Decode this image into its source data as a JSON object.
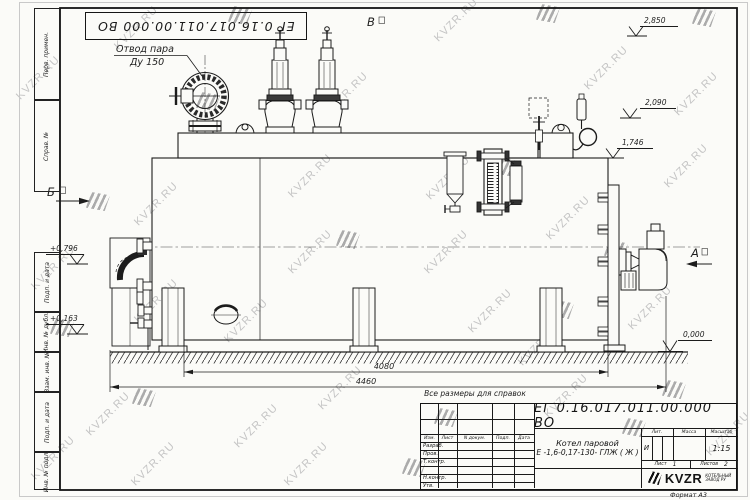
{
  "page": {
    "format_label": "Формат А3"
  },
  "watermark": {
    "text": "KVZR.RU",
    "text_color": "#c4c4c4",
    "logo_color": "#ababab"
  },
  "watermarks": [
    {
      "t": "text",
      "x": 108,
      "y": 22
    },
    {
      "t": "logo",
      "x": 228,
      "y": 6
    },
    {
      "t": "text",
      "x": 428,
      "y": 14
    },
    {
      "t": "logo",
      "x": 536,
      "y": 4
    },
    {
      "t": "logo",
      "x": 692,
      "y": 8
    },
    {
      "t": "text",
      "x": 10,
      "y": 72
    },
    {
      "t": "text",
      "x": 318,
      "y": 88
    },
    {
      "t": "text",
      "x": 578,
      "y": 62
    },
    {
      "t": "text",
      "x": 668,
      "y": 88
    },
    {
      "t": "logo",
      "x": 196,
      "y": 92
    },
    {
      "t": "text",
      "x": 128,
      "y": 198
    },
    {
      "t": "logo",
      "x": 86,
      "y": 192
    },
    {
      "t": "text",
      "x": 282,
      "y": 170
    },
    {
      "t": "text",
      "x": 420,
      "y": 172
    },
    {
      "t": "logo",
      "x": 496,
      "y": 158
    },
    {
      "t": "text",
      "x": 540,
      "y": 212
    },
    {
      "t": "text",
      "x": 658,
      "y": 160
    },
    {
      "t": "text",
      "x": 25,
      "y": 262
    },
    {
      "t": "text",
      "x": 282,
      "y": 246
    },
    {
      "t": "logo",
      "x": 336,
      "y": 230
    },
    {
      "t": "text",
      "x": 418,
      "y": 246
    },
    {
      "t": "logo",
      "x": 604,
      "y": 240
    },
    {
      "t": "text",
      "x": 128,
      "y": 295
    },
    {
      "t": "logo",
      "x": 50,
      "y": 318
    },
    {
      "t": "text",
      "x": 218,
      "y": 315
    },
    {
      "t": "text",
      "x": 462,
      "y": 305
    },
    {
      "t": "logo",
      "x": 550,
      "y": 300
    },
    {
      "t": "text",
      "x": 622,
      "y": 302
    },
    {
      "t": "text",
      "x": 512,
      "y": 338
    },
    {
      "t": "text",
      "x": 80,
      "y": 408
    },
    {
      "t": "logo",
      "x": 132,
      "y": 388
    },
    {
      "t": "text",
      "x": 312,
      "y": 382
    },
    {
      "t": "logo",
      "x": 434,
      "y": 408
    },
    {
      "t": "text",
      "x": 538,
      "y": 390
    },
    {
      "t": "text",
      "x": 228,
      "y": 420
    },
    {
      "t": "logo",
      "x": 622,
      "y": 418
    },
    {
      "t": "text",
      "x": 25,
      "y": 452
    },
    {
      "t": "text",
      "x": 125,
      "y": 458
    },
    {
      "t": "text",
      "x": 278,
      "y": 458
    },
    {
      "t": "logo",
      "x": 402,
      "y": 458
    },
    {
      "t": "logo",
      "x": 662,
      "y": 380
    },
    {
      "t": "text",
      "x": 700,
      "y": 428
    }
  ],
  "top_stamp": {
    "doc_number": "ЕГ 0.16.017.011.00.000  ВО"
  },
  "margin_fields": {
    "f1": "Перв. примен.",
    "f2": "Справ. №",
    "f3": "Подп. и дата",
    "f4": "Инв. № дубл.",
    "f5": "Взам. инв. №",
    "f6": "Подп. и дата",
    "f7": "Инв. № подл."
  },
  "drawing": {
    "callout_steam_line1": "Отвод пара",
    "callout_steam_line2": "Ду 150",
    "view_top": "В",
    "view_left": "Б",
    "view_right": "А",
    "elev_2850": "2,850",
    "elev_2090": "2,090",
    "elev_1746": "1,746",
    "elev_0796": "+0,796",
    "elev_0163": "+0,163",
    "elev_0000": "0,000",
    "dim_4080": "4080",
    "dim_4460": "4460",
    "note": "Все размеры для справок"
  },
  "title_block": {
    "doc_number": "ЕГ 0.16.017.011.00.000  ВО",
    "product_line1": "Котел паровой",
    "product_line2": "Е -1,6-0,17-130- ГЛЖ ( Ж )",
    "col_izm": "Изм.",
    "col_list": "Лист",
    "col_ndoc": "N докум.",
    "col_podp": "Подп.",
    "col_data": "Дата",
    "row_razrab": "Разраб.",
    "row_prov": "Пров.",
    "row_tkontr": "Т.контр.",
    "row_nkontr": "Н.контр.",
    "row_utv": "Утв.",
    "lit_label": "Лит.",
    "mass_label": "Масса",
    "scale_label": "Масштаб",
    "lit_value": "И",
    "scale_value": "1:15",
    "sheet_label": "Лист",
    "sheet_value": "1",
    "sheets_label": "Листов",
    "sheets_value": "2",
    "logo_text": "KVZR",
    "logo_sub1": "КОТЕЛЬНЫЙ",
    "logo_sub2": "ЗАВОД РУ"
  }
}
